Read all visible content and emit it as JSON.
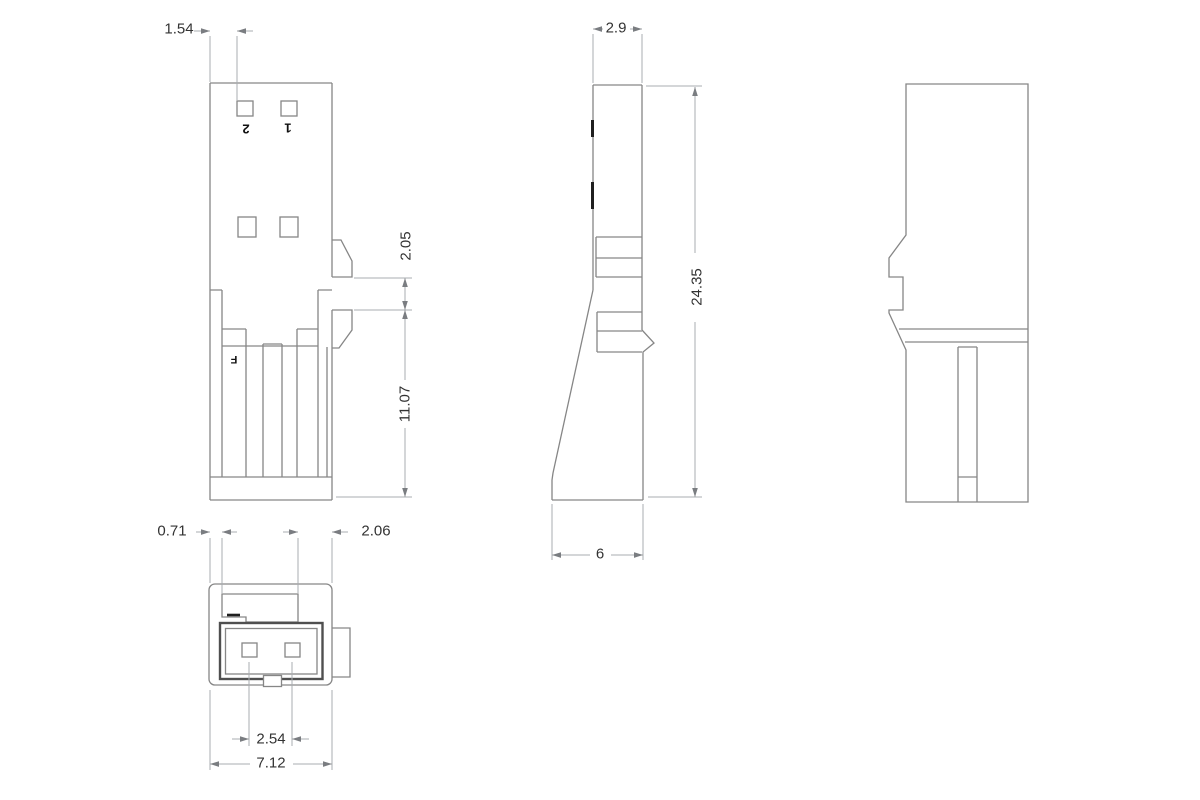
{
  "drawing": {
    "colors": {
      "background": "#ffffff",
      "line_color": "#868686",
      "heavy_color": "#4f4f4f",
      "tick_color": "#1f1f1f",
      "dim_color": "#a9acb0",
      "text_color": "#333333"
    },
    "views": {
      "front": {
        "label_pin2": "2",
        "label_pin1": "1",
        "label_f": "F",
        "dim_pin_offset": "1.54",
        "dim_latch_window": "2.05",
        "dim_lower_body": "11.07"
      },
      "side": {
        "dim_wall_width": "2.9",
        "dim_overall_height": "24.35",
        "dim_base_depth": "6"
      },
      "bottom": {
        "dim_wall_thickness": "0.71",
        "dim_latch_width": "2.06",
        "dim_pin_pitch": "2.54",
        "dim_overall_width": "7.12"
      }
    }
  }
}
